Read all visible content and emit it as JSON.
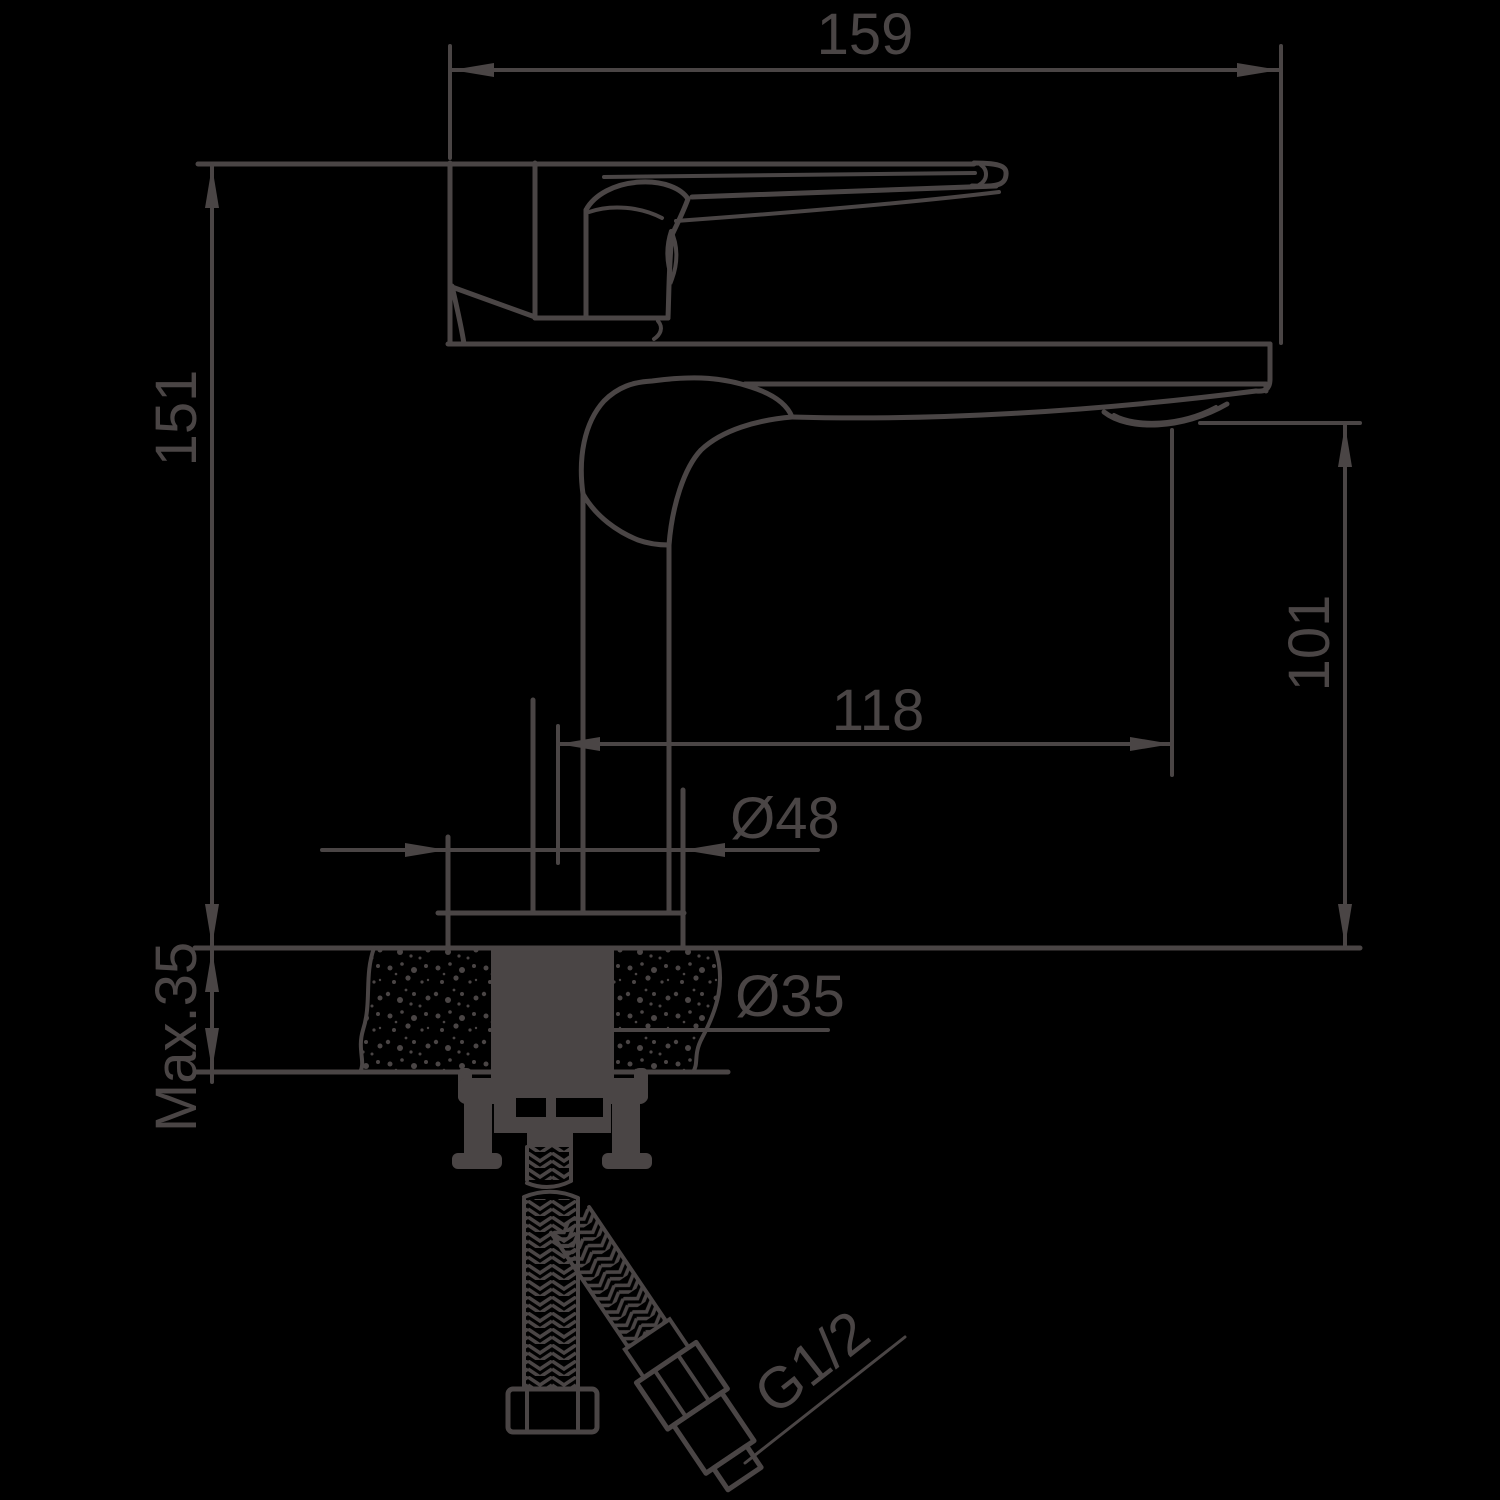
{
  "drawing": {
    "type": "technical-dimension-drawing",
    "subject": "single-lever basin faucet side view with mounting hose",
    "colors": {
      "background": "#000000",
      "ink": "#4a4545"
    },
    "dims": {
      "overall_width": "159",
      "overall_height": "151",
      "spout_height": "101",
      "spout_reach": "118",
      "base_diameter": "Ø48",
      "max_counter_thickness": "Max.35",
      "hole_diameter": "Ø35",
      "connection_thread": "G1/2"
    }
  }
}
